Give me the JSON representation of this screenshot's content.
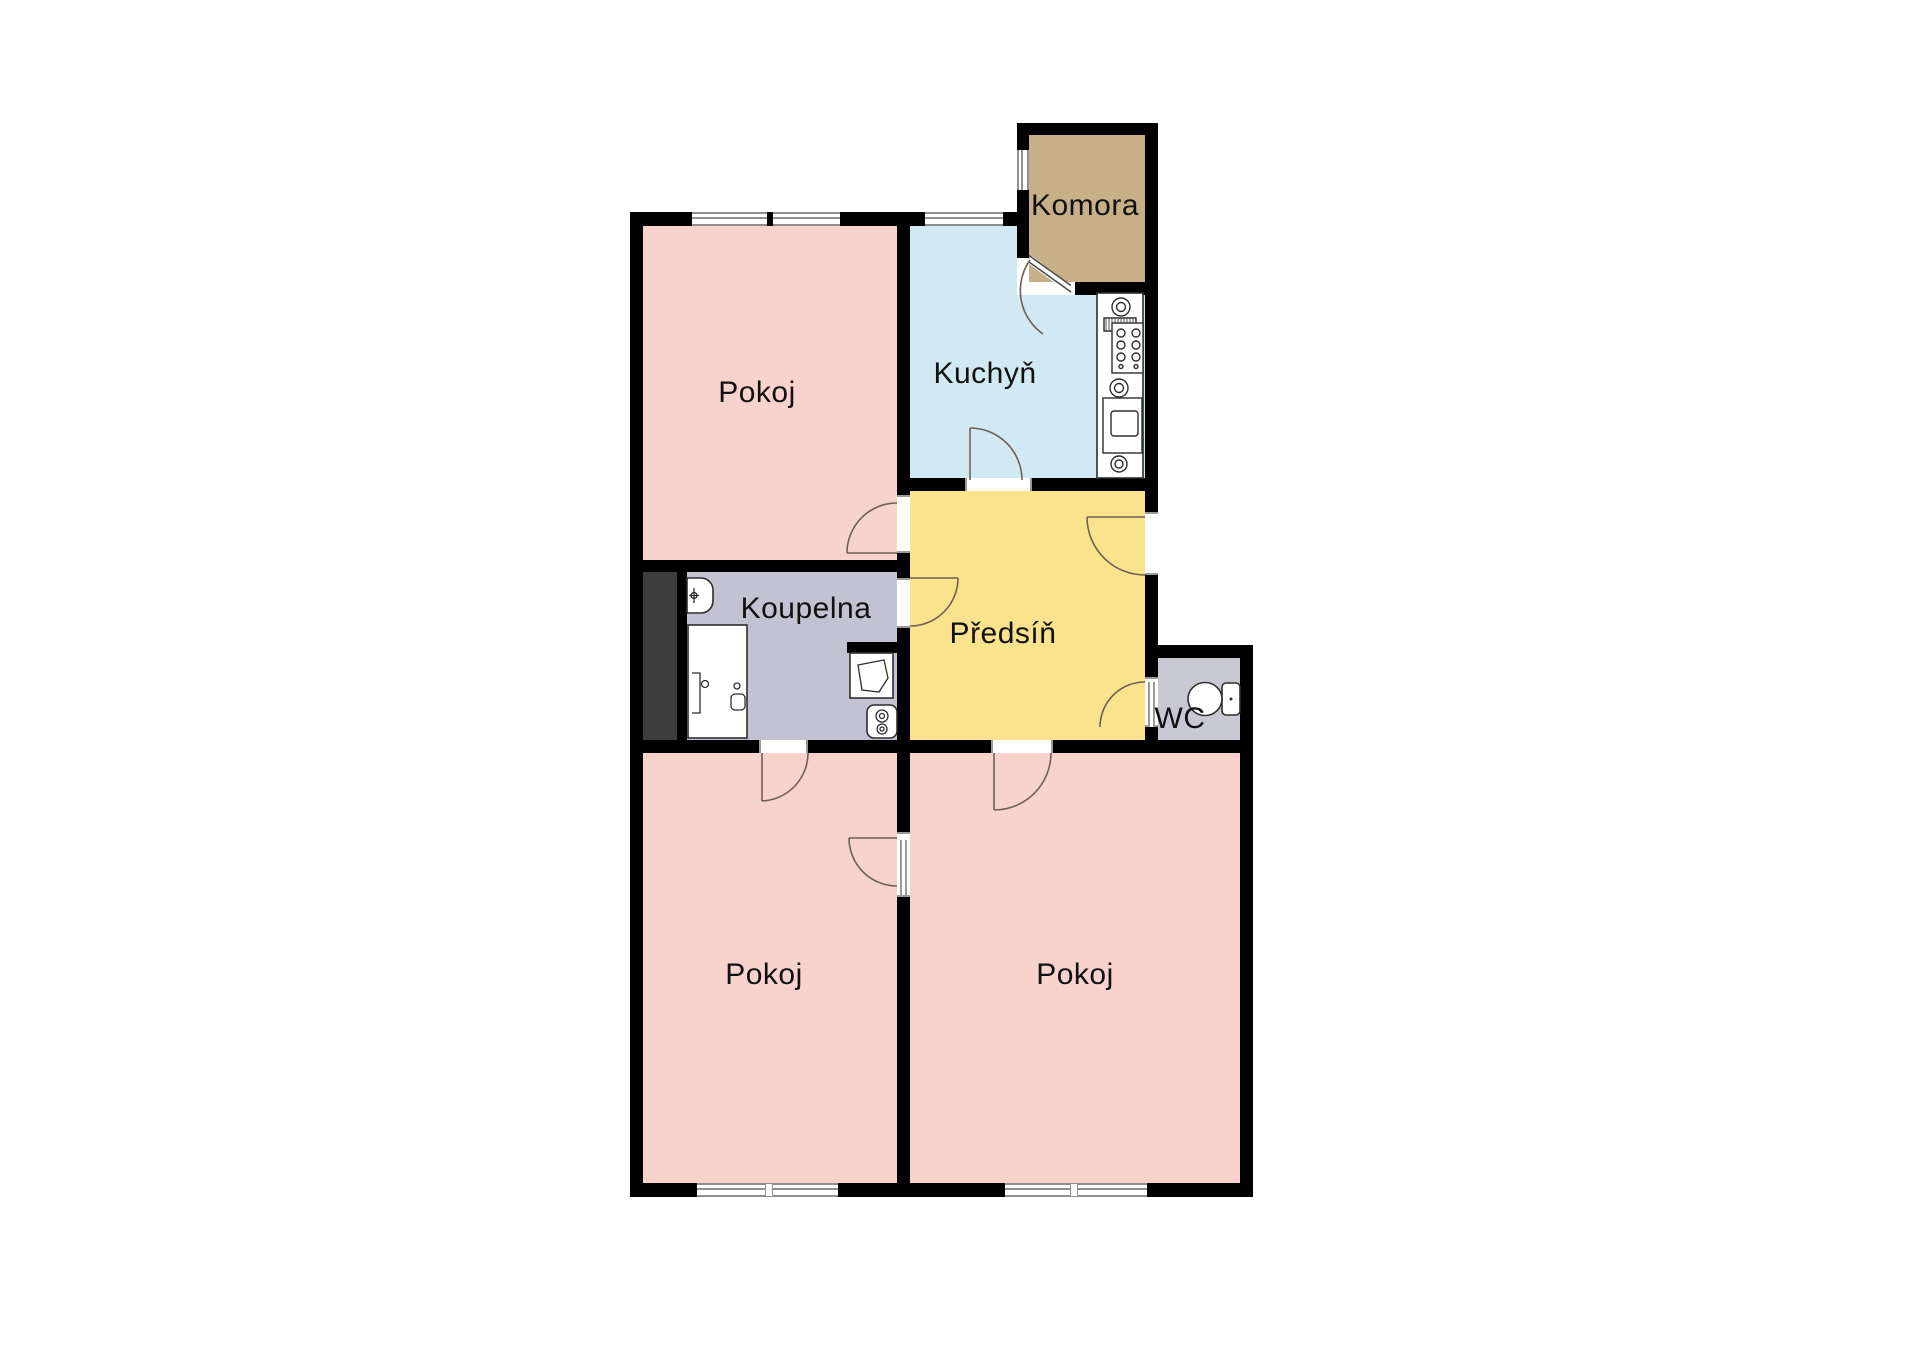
{
  "floorplan": {
    "rooms": [
      {
        "id": "pokoj-top",
        "label": "Pokoj"
      },
      {
        "id": "kuchyn",
        "label": "Kuchyň"
      },
      {
        "id": "komora",
        "label": "Komora"
      },
      {
        "id": "koupelna",
        "label": "Koupelna"
      },
      {
        "id": "predsin",
        "label": "Předsíň"
      },
      {
        "id": "wc",
        "label": "WC"
      },
      {
        "id": "pokoj-bottom-left",
        "label": "Pokoj"
      },
      {
        "id": "pokoj-bottom-right",
        "label": "Pokoj"
      }
    ],
    "colors": {
      "pokoj": "#f8d2cd",
      "kuchyn": "#d0e9f2",
      "komora": "#c7af88",
      "koupelna": "#c2c2d3",
      "predsin": "#fbe28d",
      "wc": "#c8c8d2",
      "shaft": "#3d3d3d",
      "wall": "#000000",
      "background": "#ffffff"
    }
  }
}
